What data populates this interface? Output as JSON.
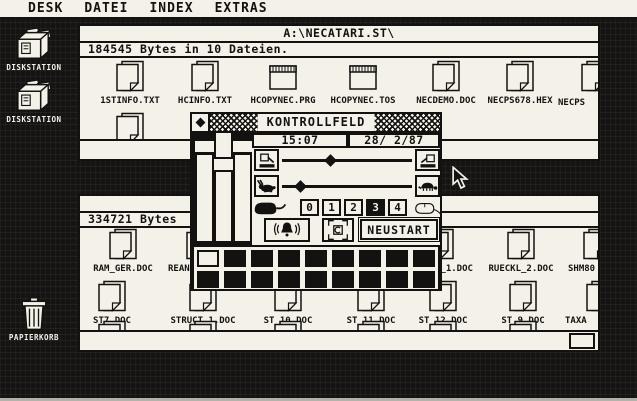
{
  "menu": {
    "items": [
      {
        "label": "DESK"
      },
      {
        "label": "DATEI"
      },
      {
        "label": "INDEX"
      },
      {
        "label": "EXTRAS"
      }
    ]
  },
  "desktop": {
    "icons": [
      {
        "label": "DISKSTATION",
        "icon": "floppy-drive-icon"
      },
      {
        "label": "DISKSTATION",
        "icon": "floppy-drive-icon"
      },
      {
        "label": "PAPIERKORB",
        "icon": "trash-icon"
      }
    ]
  },
  "window1": {
    "title": "A:\\NECATARI.ST\\",
    "info": "184545 Bytes in 10 Dateien.",
    "files": [
      {
        "name": "1STINFO.TXT",
        "icon": "document-icon"
      },
      {
        "name": "HCINFO.TXT",
        "icon": "document-icon"
      },
      {
        "name": "HCOPYNEC.PRG",
        "icon": "application-icon"
      },
      {
        "name": "HCOPYNEC.TOS",
        "icon": "application-icon"
      },
      {
        "name": "NECDEMO.DOC",
        "icon": "document-icon"
      },
      {
        "name": "NECPS678.HEX",
        "icon": "document-icon"
      },
      {
        "name": "NECPS",
        "icon": "document-icon",
        "clipped": true
      }
    ]
  },
  "window2": {
    "info": "334721 Bytes",
    "files_row1": [
      {
        "name": "RAM_GER.DOC",
        "icon": "document-icon"
      },
      {
        "name": "REAN",
        "icon": "document-icon",
        "partially_hidden": true
      },
      {
        "name": "L_1.DOC",
        "icon": "document-icon",
        "partially_hidden": true
      },
      {
        "name": "RUECKL_2.DOC",
        "icon": "document-icon"
      },
      {
        "name": "SHM80",
        "icon": "document-icon",
        "clipped": true
      }
    ],
    "files_row2": [
      {
        "name": "ST7.DOC",
        "icon": "document-icon"
      },
      {
        "name": "STRUCT_1.DOC",
        "icon": "document-icon"
      },
      {
        "name": "ST_10.DOC",
        "icon": "document-icon"
      },
      {
        "name": "ST_11.DOC",
        "icon": "document-icon"
      },
      {
        "name": "ST_12.DOC",
        "icon": "document-icon"
      },
      {
        "name": "ST_9.DOC",
        "icon": "document-icon"
      },
      {
        "name": "TAXA",
        "icon": "document-icon",
        "clipped": true
      }
    ]
  },
  "control_panel": {
    "title": "KONTROLLFELD",
    "time": "15:07",
    "date": "28/ 2/87",
    "double_click_levels": [
      "0",
      "1",
      "2",
      "3",
      "4"
    ],
    "double_click_selected": "3",
    "restart_label": "NEUSTART",
    "icons": {
      "close": "close-box-icon",
      "key_click_soft": "key-press-soft-icon",
      "key_click_loud": "key-press-loud-icon",
      "repeat_fast": "rabbit-icon",
      "repeat_slow": "turtle-icon",
      "mouse_left": "mouse-black-icon",
      "mouse_right": "mouse-outline-icon",
      "bell_button": "bell-sound-icon",
      "center_button": "c-box-arrows-icon"
    }
  },
  "colors": {
    "paper": "#f4f1e9",
    "ink": "#141210",
    "desktop": "#161412"
  },
  "cursor": {
    "icon": "arrow-pointer"
  }
}
